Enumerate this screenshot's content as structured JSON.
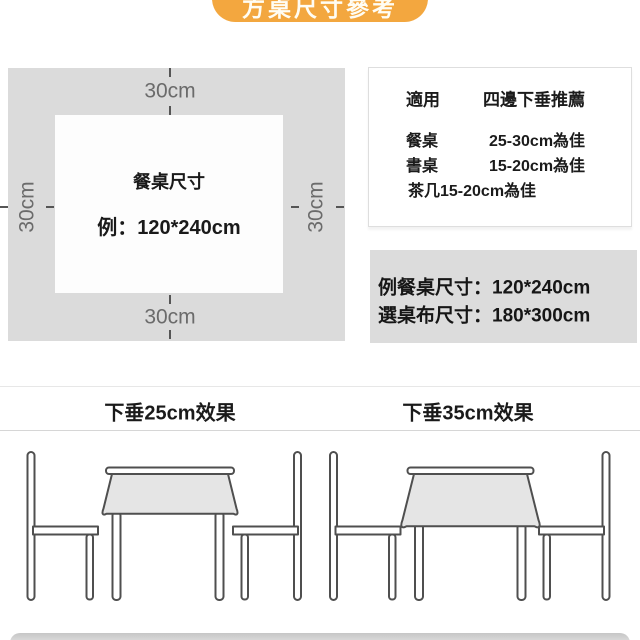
{
  "page": {
    "title_badge": "方桌尺寸參考",
    "accent_color": "#F3A73F"
  },
  "diagram": {
    "top_label": "30cm",
    "bottom_label": "30cm",
    "left_label": "30cm",
    "right_label": "30cm",
    "table_title": "餐桌尺寸",
    "table_example": "例：120*240cm",
    "cloth_color": "#DBDBDB"
  },
  "recommendation_panel": {
    "header_col1": "適用",
    "header_col2": "四邊下垂推薦",
    "rows": [
      {
        "label": "餐桌",
        "value": "25-30cm為佳"
      },
      {
        "label": "書桌",
        "value": "15-20cm為佳"
      },
      {
        "label": "茶几15-20cm為佳",
        "value": ""
      }
    ]
  },
  "example_box": {
    "line1": "例餐桌尺寸：120*240cm",
    "line2": "選桌布尺寸：180*300cm",
    "background": "#DCDCDC"
  },
  "effects": {
    "left_label": "下垂25cm效果",
    "right_label": "下垂35cm效果"
  }
}
